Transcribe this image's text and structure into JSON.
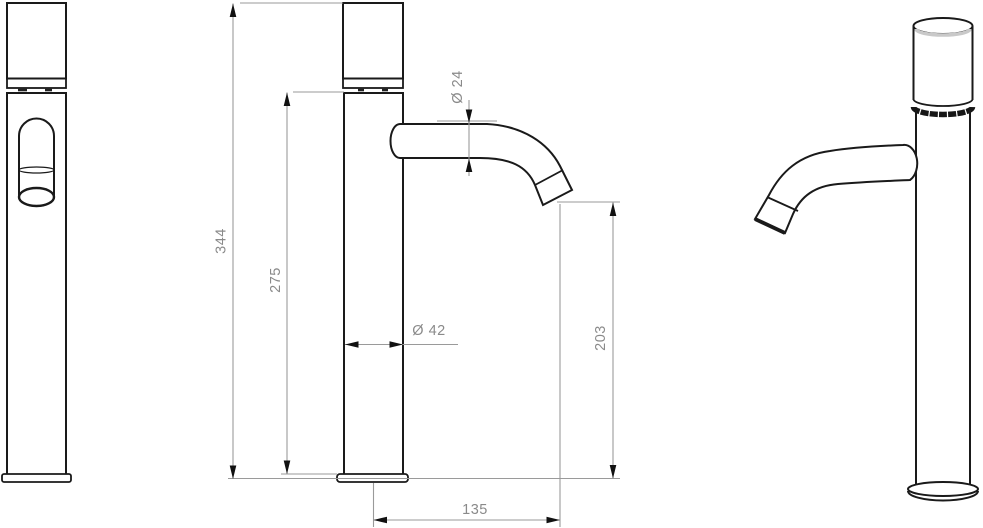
{
  "drawing": {
    "type": "faucet-technical-drawing",
    "views": {
      "front": "front-view",
      "side": "side-view-with-dimensions",
      "perspective": "perspective-view"
    },
    "dimensions": {
      "overall_height": "344",
      "upper_body_height": "275",
      "spout_tube_diameter": "Ø 24",
      "body_diameter": "Ø 42",
      "outlet_height": "203",
      "spout_reach": "135"
    },
    "colors": {
      "background": "#ffffff",
      "outline": "#1a1a1a",
      "dimension_lines": "#9a9a9a",
      "dimension_text": "#8a8a8a",
      "cap_shading": "#c9c9c9",
      "dark_band": "#161616"
    }
  }
}
